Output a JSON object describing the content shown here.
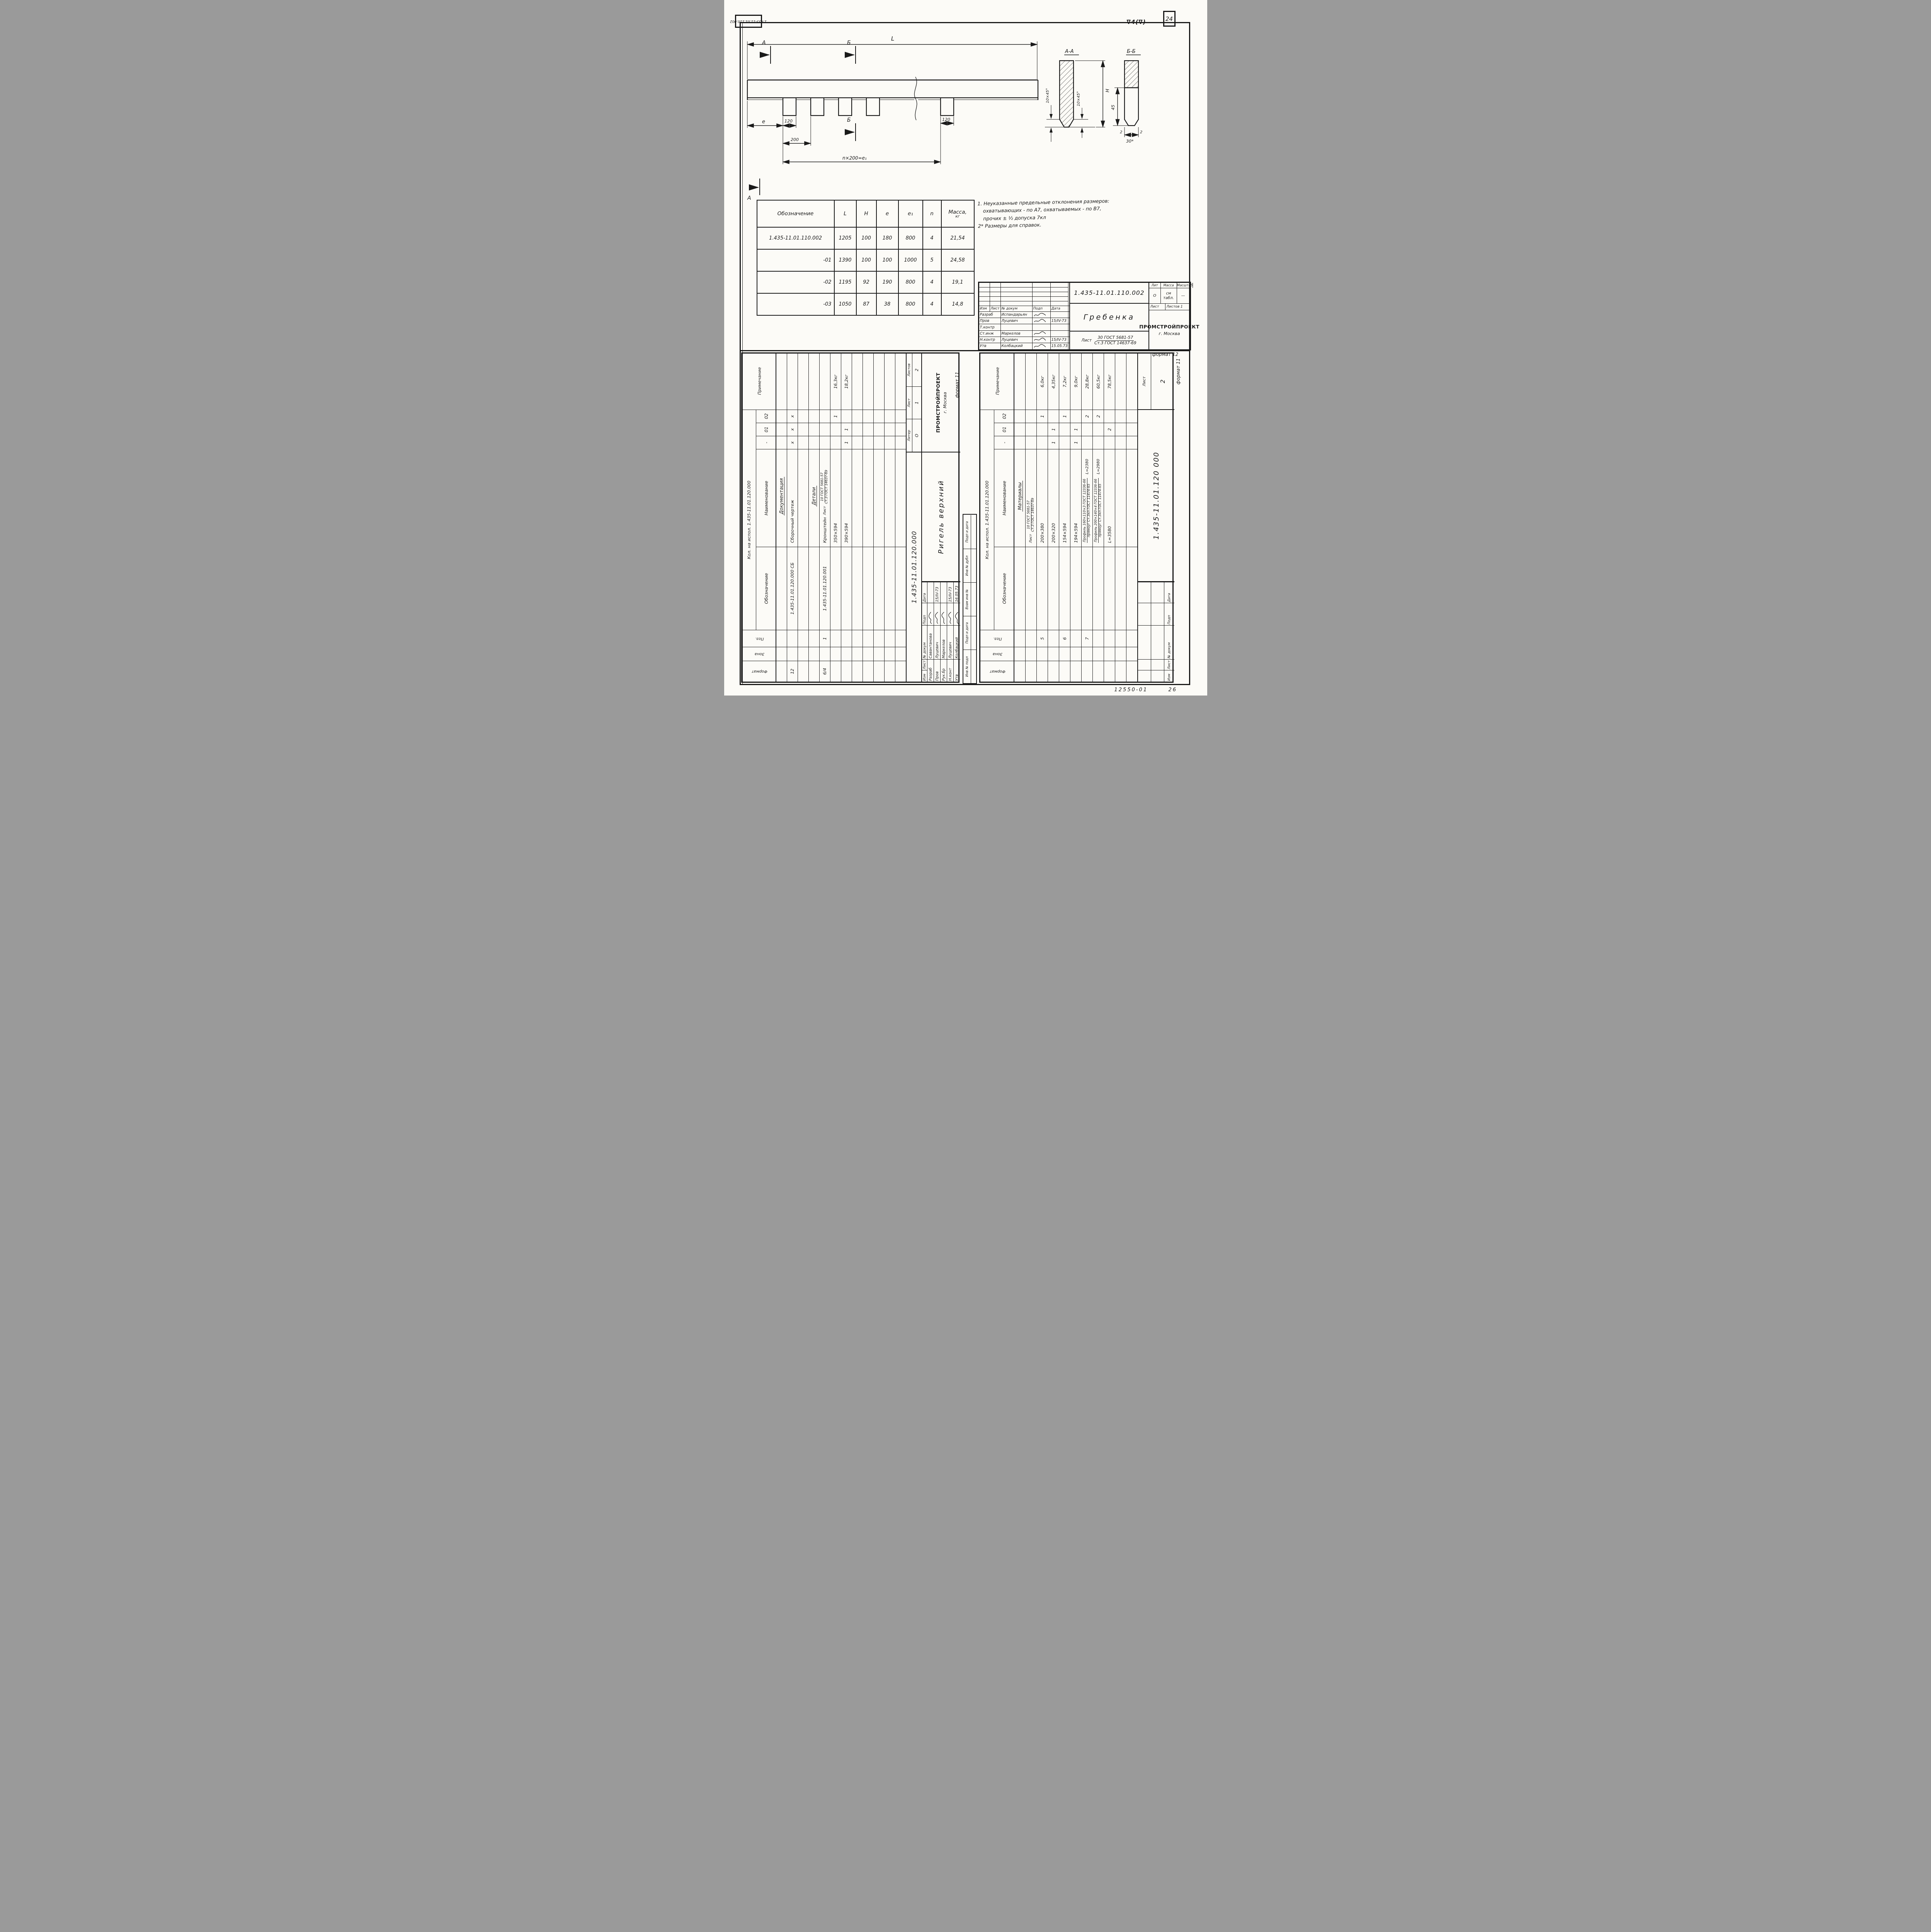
{
  "page": {
    "corner_stamp": "1.435-11.01.110.002",
    "surface_finish": "∇4(∇)",
    "page_number": "24",
    "archive_number": "12550-01",
    "bottom_right_number": "26"
  },
  "drawing": {
    "dims": {
      "L": "L",
      "e": "e",
      "t120": "120",
      "t200": "200",
      "t120r": "120",
      "pitch": "n×200=e₁",
      "secA": "А",
      "secB": "Б"
    },
    "sections": {
      "aa_title": "А-А",
      "bb_title": "Б-Б",
      "chamfer": "10×45°",
      "H": "H",
      "h45": "45",
      "w30": "30*",
      "t2l": "2",
      "t2r": "2"
    }
  },
  "table": {
    "headers": [
      "Обозначение",
      "L",
      "H",
      "e",
      "e₁",
      "n",
      "Масса,"
    ],
    "header_kg": "кг",
    "rows": [
      [
        "1.435-11.01.110.002",
        "1205",
        "100",
        "180",
        "800",
        "4",
        "21,54"
      ],
      [
        "-01",
        "1390",
        "100",
        "100",
        "1000",
        "5",
        "24,58"
      ],
      [
        "-02",
        "1195",
        "92",
        "190",
        "800",
        "4",
        "19,1"
      ],
      [
        "-03",
        "1050",
        "87",
        "38",
        "800",
        "4",
        "14,8"
      ]
    ]
  },
  "notes": [
    "1. Неуказанные предельные отклонения размеров:",
    "охватывающих - по А7, охватываемых - по В7,",
    "прочих ± ½ допуска 7кл",
    "2* Размеры для справок."
  ],
  "labels": {
    "izm": "Изм",
    "list": "Лист",
    "ndoc": "№ докум",
    "podp": "Подп",
    "data": "Дата",
    "lit": "Лит",
    "liter": "Литер",
    "massa": "Масса",
    "masshtab": "Масштаб",
    "listov": "Листов"
  },
  "org": {
    "name": "ПРОМСТРОЙПРОЕКТ",
    "city": "г. Москва"
  },
  "title_block": {
    "doc_number": "1.435-11.01.110.002",
    "title": "Гребенка",
    "material_prefix": "Лист",
    "material_top": "30 ГОСТ 5681-57",
    "material_bottom": "Ст.3 ГОСТ 14637-69",
    "liter_value": "О",
    "massa_value": "см табл.",
    "masshtab_value": "—",
    "list_value": "",
    "listov_value": "Листов 1",
    "format_note": "формат 12",
    "sigs": [
      {
        "role": "Разраб",
        "name": "Испандарьян",
        "date": ""
      },
      {
        "role": "Пров",
        "name": "Луцевич",
        "date": "15/IV-73"
      },
      {
        "role": "Т.контр",
        "name": "",
        "date": ""
      },
      {
        "role": "Ст.инж",
        "name": "Маркелов",
        "date": ""
      },
      {
        "role": "Н.контр",
        "name": "Луцевич",
        "date": "15/IV-73"
      },
      {
        "role": "Утв",
        "name": "Колбацкий",
        "date": "15.05.73"
      }
    ]
  },
  "spec_cols": {
    "format": "Формат",
    "zone": "Зона",
    "poz": "Поз.",
    "designation": "Обозначение",
    "name": "Наименование",
    "q1": "-",
    "q2": "01",
    "q3": "02",
    "note": "Примечание"
  },
  "spec_left": {
    "usage": "Кол. на испол. 1.435-11.01.120.000",
    "rows": [
      {
        "section": "Документация"
      },
      {
        "f": "12",
        "d": "1.435-11.01.120.000 СБ",
        "n": "Сборочный чертеж",
        "q": [
          "x",
          "x",
          "x"
        ]
      },
      {},
      {
        "section": "Детали"
      },
      {
        "f": "6/4",
        "p": "1",
        "d": "1.435-11.01.120.001",
        "n": "Кронштейн",
        "mp": "Лист",
        "nt": "10 ГОСТ 5681-57",
        "nb": "Ст.3 ГОСТ 14637-69",
        "q": [
          "",
          "",
          ""
        ]
      },
      {
        "n": "350×594",
        "q": [
          "",
          "",
          "1"
        ],
        "note": "16,3кг"
      },
      {
        "n": "390×594",
        "q": [
          "1",
          "1",
          ""
        ],
        "note": "18,2кг"
      },
      {},
      {},
      {},
      {},
      {}
    ],
    "title_block": {
      "doc": "1.435-11.01.120.000",
      "title": "Ригель верхний",
      "liter": "О",
      "list": "1",
      "listov": "2",
      "format_note": "формат 11",
      "sigs": [
        {
          "role": "Разраб",
          "name": "Савантанова",
          "date": ""
        },
        {
          "role": "Пров",
          "name": "Луцевич",
          "date": "15/IV-73"
        },
        {
          "role": "Рук.бр",
          "name": "Маркелов",
          "date": ""
        },
        {
          "role": "Н.конт",
          "name": "Луцевич",
          "date": "15/IV-73"
        },
        {
          "role": "Утв",
          "name": "Колбацкий",
          "date": "16.05.73"
        }
      ]
    }
  },
  "spec_right": {
    "usage": "Кол. на испол. 1.435-11.01.120.000",
    "rows": [
      {
        "section": "Материалы"
      },
      {
        "mp": "Лист",
        "nt": "10 ГОСТ 5681-57",
        "nb": "Ст.3 ГОСТ 14637-69",
        "q": [
          "",
          "",
          ""
        ]
      },
      {
        "p": "5",
        "n": "200×380",
        "q": [
          "",
          "",
          "1"
        ],
        "note": "6,0кг"
      },
      {
        "n": "200×320",
        "q": [
          "1",
          "1",
          ""
        ],
        "note": "4,35кг"
      },
      {
        "p": "6",
        "n": "154×594",
        "q": [
          "",
          "",
          "1"
        ],
        "note": "7,2кг"
      },
      {
        "n": "194×594",
        "q": [
          "1",
          "1",
          ""
        ],
        "note": "9,0кг"
      },
      {
        "p": "7",
        "nt": "Профиль 160×110×3 ГОСТ 12336-66",
        "nb": "прямоуг Ст.3кп ГОСТ 11474-65",
        "nx": "L=2380",
        "q": [
          "",
          "",
          "2"
        ],
        "note": "28,8кг"
      },
      {
        "nt": "Профиль 200×140×4 ГОСТ 12336-66",
        "nb": "прямоуг Ст.3кп ГОСТ 11474-65",
        "nx": "L=2980",
        "q": [
          "",
          "",
          "2"
        ],
        "note": "60,5кг"
      },
      {
        "n": "L=3580",
        "q": [
          "",
          "2",
          ""
        ],
        "note": "78,5кг"
      },
      {},
      {}
    ],
    "cont_block": {
      "doc": "1.435-11.01.120 000",
      "list_label": "Лист",
      "list_value": "2",
      "format_note": "формат 11"
    }
  },
  "stamp_strip": [
    "Инв № подл",
    "Подп и дата",
    "Взам инв №",
    "Инв № дубл",
    "Подп и дата"
  ]
}
